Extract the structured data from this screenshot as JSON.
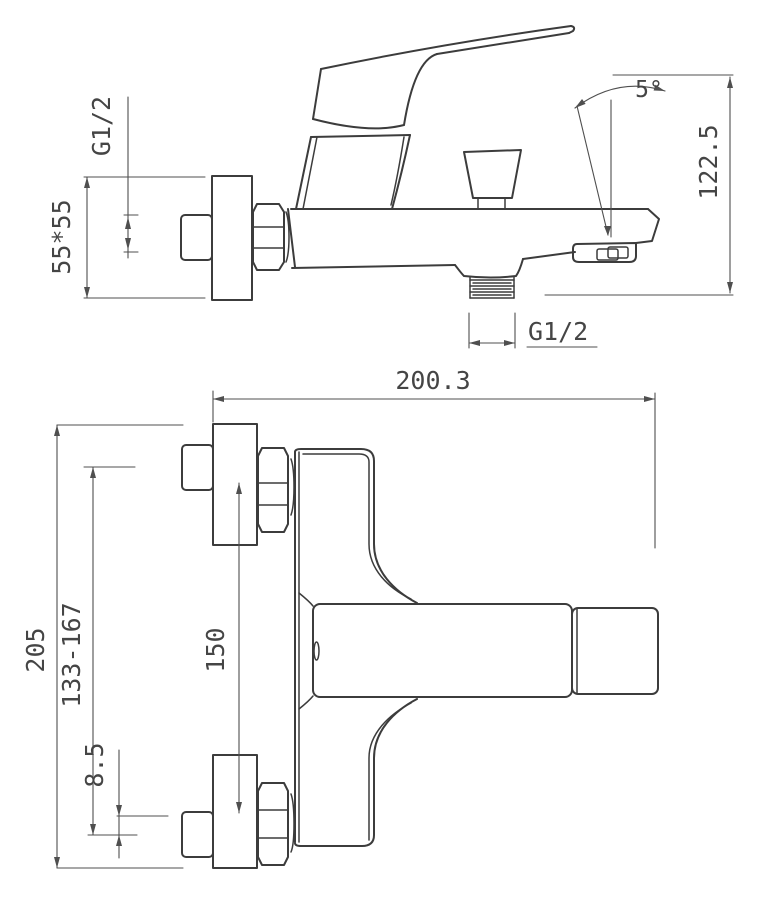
{
  "drawing": {
    "title": "bath-shower mixer installation dimensions",
    "side_view": {
      "inlet_thread_label": "G1/2",
      "escutcheon_size_label": "55*55",
      "spout_angle_label": "5°",
      "overall_height_label": "122.5",
      "outlet_thread_label": "G1/2"
    },
    "front_view": {
      "wall_to_spout_label": "200.3",
      "overall_height_label": "205",
      "adjust_range_label": "133-167",
      "inlet_center_distance_label": "150",
      "eccentric_offset_label": "8.5"
    }
  },
  "colors": {
    "line": "#3c3c3c",
    "dimension": "#4f4f4f",
    "background": "#ffffff"
  }
}
